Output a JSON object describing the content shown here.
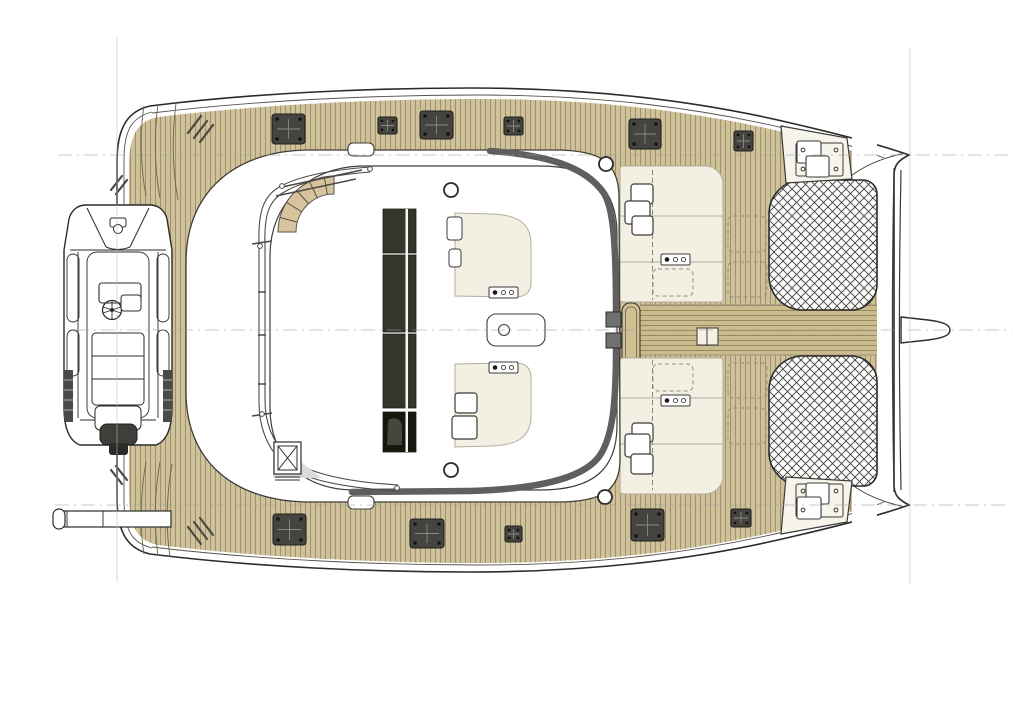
{
  "meta": {
    "description": "Catamaran yacht deck plan, top view, bow to the right",
    "canvas": {
      "w": 1024,
      "h": 723
    }
  },
  "colors": {
    "outline": "#2c2b29",
    "thin_line": "#4c4a45",
    "wood": "#cfc29a",
    "wood_line": "rgba(109,96,59,0.5)",
    "wood_bridge": "#cbbc8f",
    "cream": "#f3efe2",
    "cream_stroke": "#b3ad9c",
    "white": "#ffffff",
    "hatch_fill": "#454440",
    "hatch_stroke": "#201f1d",
    "hatch_cross": "#8a8a82",
    "band_gray": "#5f5f5d",
    "sunroof": "#35352c",
    "sunroof_dark": "#17170f",
    "tramp_line": "#3e3e3e",
    "construction": "#9d9d9b",
    "gray_area": "#dadad8",
    "stair_wood": "#d8c49c",
    "motor_dark": "#3e3e3a"
  },
  "construction_lines": {
    "horizontal": [
      {
        "y": 155,
        "x1": 58,
        "x2": 1008
      },
      {
        "y": 330,
        "x1": 75,
        "x2": 1012
      },
      {
        "y": 505,
        "x1": 55,
        "x2": 1008
      }
    ],
    "vertical": [
      {
        "x": 117,
        "y1": 38,
        "y2": 582
      },
      {
        "x": 910,
        "y1": 48,
        "y2": 584
      }
    ]
  },
  "hatches": [
    {
      "x": 272,
      "y": 114,
      "w": 33,
      "h": 30,
      "type": "large"
    },
    {
      "x": 378,
      "y": 117,
      "w": 19,
      "h": 17,
      "type": "small"
    },
    {
      "x": 420,
      "y": 111,
      "w": 33,
      "h": 28,
      "type": "large"
    },
    {
      "x": 504,
      "y": 117,
      "w": 19,
      "h": 18,
      "type": "small"
    },
    {
      "x": 629,
      "y": 119,
      "w": 32,
      "h": 30,
      "type": "large"
    },
    {
      "x": 734,
      "y": 131,
      "w": 19,
      "h": 20,
      "type": "small"
    },
    {
      "x": 273,
      "y": 514,
      "w": 33,
      "h": 31,
      "type": "large"
    },
    {
      "x": 410,
      "y": 519,
      "w": 34,
      "h": 29,
      "type": "large"
    },
    {
      "x": 505,
      "y": 526,
      "w": 17,
      "h": 16,
      "type": "small"
    },
    {
      "x": 631,
      "y": 509,
      "w": 33,
      "h": 32,
      "type": "large"
    },
    {
      "x": 731,
      "y": 509,
      "w": 20,
      "h": 18,
      "type": "small"
    }
  ],
  "deck_circles": [
    {
      "cx": 451,
      "cy": 190,
      "r": 7
    },
    {
      "cx": 451,
      "cy": 470,
      "r": 7
    },
    {
      "cx": 606,
      "cy": 164,
      "r": 7
    },
    {
      "cx": 605,
      "cy": 497,
      "r": 7
    }
  ],
  "vents": [
    [
      [
        188,
        133,
        201,
        116
      ],
      [
        194,
        138,
        207,
        121
      ],
      [
        200,
        142,
        213,
        125
      ]
    ],
    [
      [
        111,
        190,
        122,
        176
      ],
      [
        116,
        194,
        127,
        180
      ]
    ],
    [
      [
        111,
        470,
        122,
        484
      ],
      [
        116,
        466,
        127,
        480
      ]
    ],
    [
      [
        188,
        527,
        201,
        544
      ],
      [
        194,
        522,
        207,
        539
      ],
      [
        200,
        518,
        213,
        535
      ]
    ]
  ],
  "trampolines": [
    {
      "x": 769,
      "y": 180,
      "w": 108,
      "h": 130,
      "r": [
        34,
        14,
        26,
        34
      ]
    },
    {
      "x": 769,
      "y": 356,
      "w": 108,
      "h": 130,
      "r": [
        34,
        26,
        14,
        34
      ]
    }
  ],
  "sunroof": {
    "x": 383,
    "w": 33,
    "seam_x": 405.5,
    "segments": [
      {
        "y": 209,
        "h": 44,
        "dark": false
      },
      {
        "y": 255,
        "h": 77,
        "dark": false
      },
      {
        "y": 334,
        "h": 74,
        "dark": false
      },
      {
        "y": 412,
        "h": 40,
        "dark": true
      }
    ]
  },
  "control_panels": [
    {
      "x": 489,
      "y": 287
    },
    {
      "x": 489,
      "y": 362
    },
    {
      "x": 661,
      "y": 254
    },
    {
      "x": 661,
      "y": 395
    }
  ],
  "winches_fly": [
    {
      "x": 455,
      "y": 393,
      "s": 22
    },
    {
      "x": 452,
      "y": 416,
      "s": 25
    }
  ],
  "winches_foredeck": [
    {
      "x": 631,
      "y": 184,
      "s": 22
    },
    {
      "x": 625,
      "y": 201,
      "s": 25
    },
    {
      "x": 632,
      "y": 216,
      "s": 21
    },
    {
      "x": 632,
      "y": 423,
      "s": 21
    },
    {
      "x": 625,
      "y": 434,
      "s": 25
    },
    {
      "x": 631,
      "y": 454,
      "s": 22
    }
  ],
  "windlass": {
    "plates": [
      {
        "x": 796,
        "y": 143,
        "w": 47,
        "h": 33
      },
      {
        "x": 796,
        "y": 484,
        "w": 47,
        "h": 33
      }
    ],
    "squares": [
      {
        "x": 797,
        "y": 141,
        "w": 24,
        "h": 22
      },
      {
        "x": 806,
        "y": 156,
        "w": 23,
        "h": 21
      },
      {
        "x": 806,
        "y": 483,
        "w": 23,
        "h": 21
      },
      {
        "x": 797,
        "y": 497,
        "w": 24,
        "h": 22
      }
    ],
    "bolts": [
      [
        803,
        150
      ],
      [
        836,
        150
      ],
      [
        803,
        169
      ],
      [
        836,
        169
      ],
      [
        803,
        491
      ],
      [
        836,
        491
      ],
      [
        803,
        510
      ],
      [
        836,
        510
      ]
    ]
  },
  "lockers_dashed": [
    {
      "x": 728,
      "y": 216,
      "w": 38,
      "h": 36
    },
    {
      "x": 728,
      "y": 262,
      "w": 39,
      "h": 35
    },
    {
      "x": 728,
      "y": 363,
      "w": 39,
      "h": 35
    },
    {
      "x": 728,
      "y": 408,
      "w": 38,
      "h": 36
    },
    {
      "x": 653,
      "y": 269,
      "w": 40,
      "h": 27
    },
    {
      "x": 653,
      "y": 364,
      "w": 40,
      "h": 27
    }
  ],
  "cream_foredeck_panels": [
    {
      "x": 620,
      "y": 166,
      "w": 103,
      "h": 136,
      "r": [
        3,
        18,
        3,
        3
      ],
      "lines_y": [
        216,
        262
      ],
      "dash_x": 652.5,
      "dash_y1": 170,
      "dash_y2": 300
    },
    {
      "x": 620,
      "y": 358,
      "w": 103,
      "h": 136,
      "r": [
        3,
        3,
        18,
        3
      ],
      "lines_y": [
        398,
        444
      ],
      "dash_x": 652.5,
      "dash_y1": 360,
      "dash_y2": 490
    }
  ],
  "stairs": {
    "cx": 334,
    "cy": 232,
    "r_inner": 38,
    "r_outer": 56,
    "step_angles": [
      195,
      212,
      228,
      244,
      260
    ]
  }
}
